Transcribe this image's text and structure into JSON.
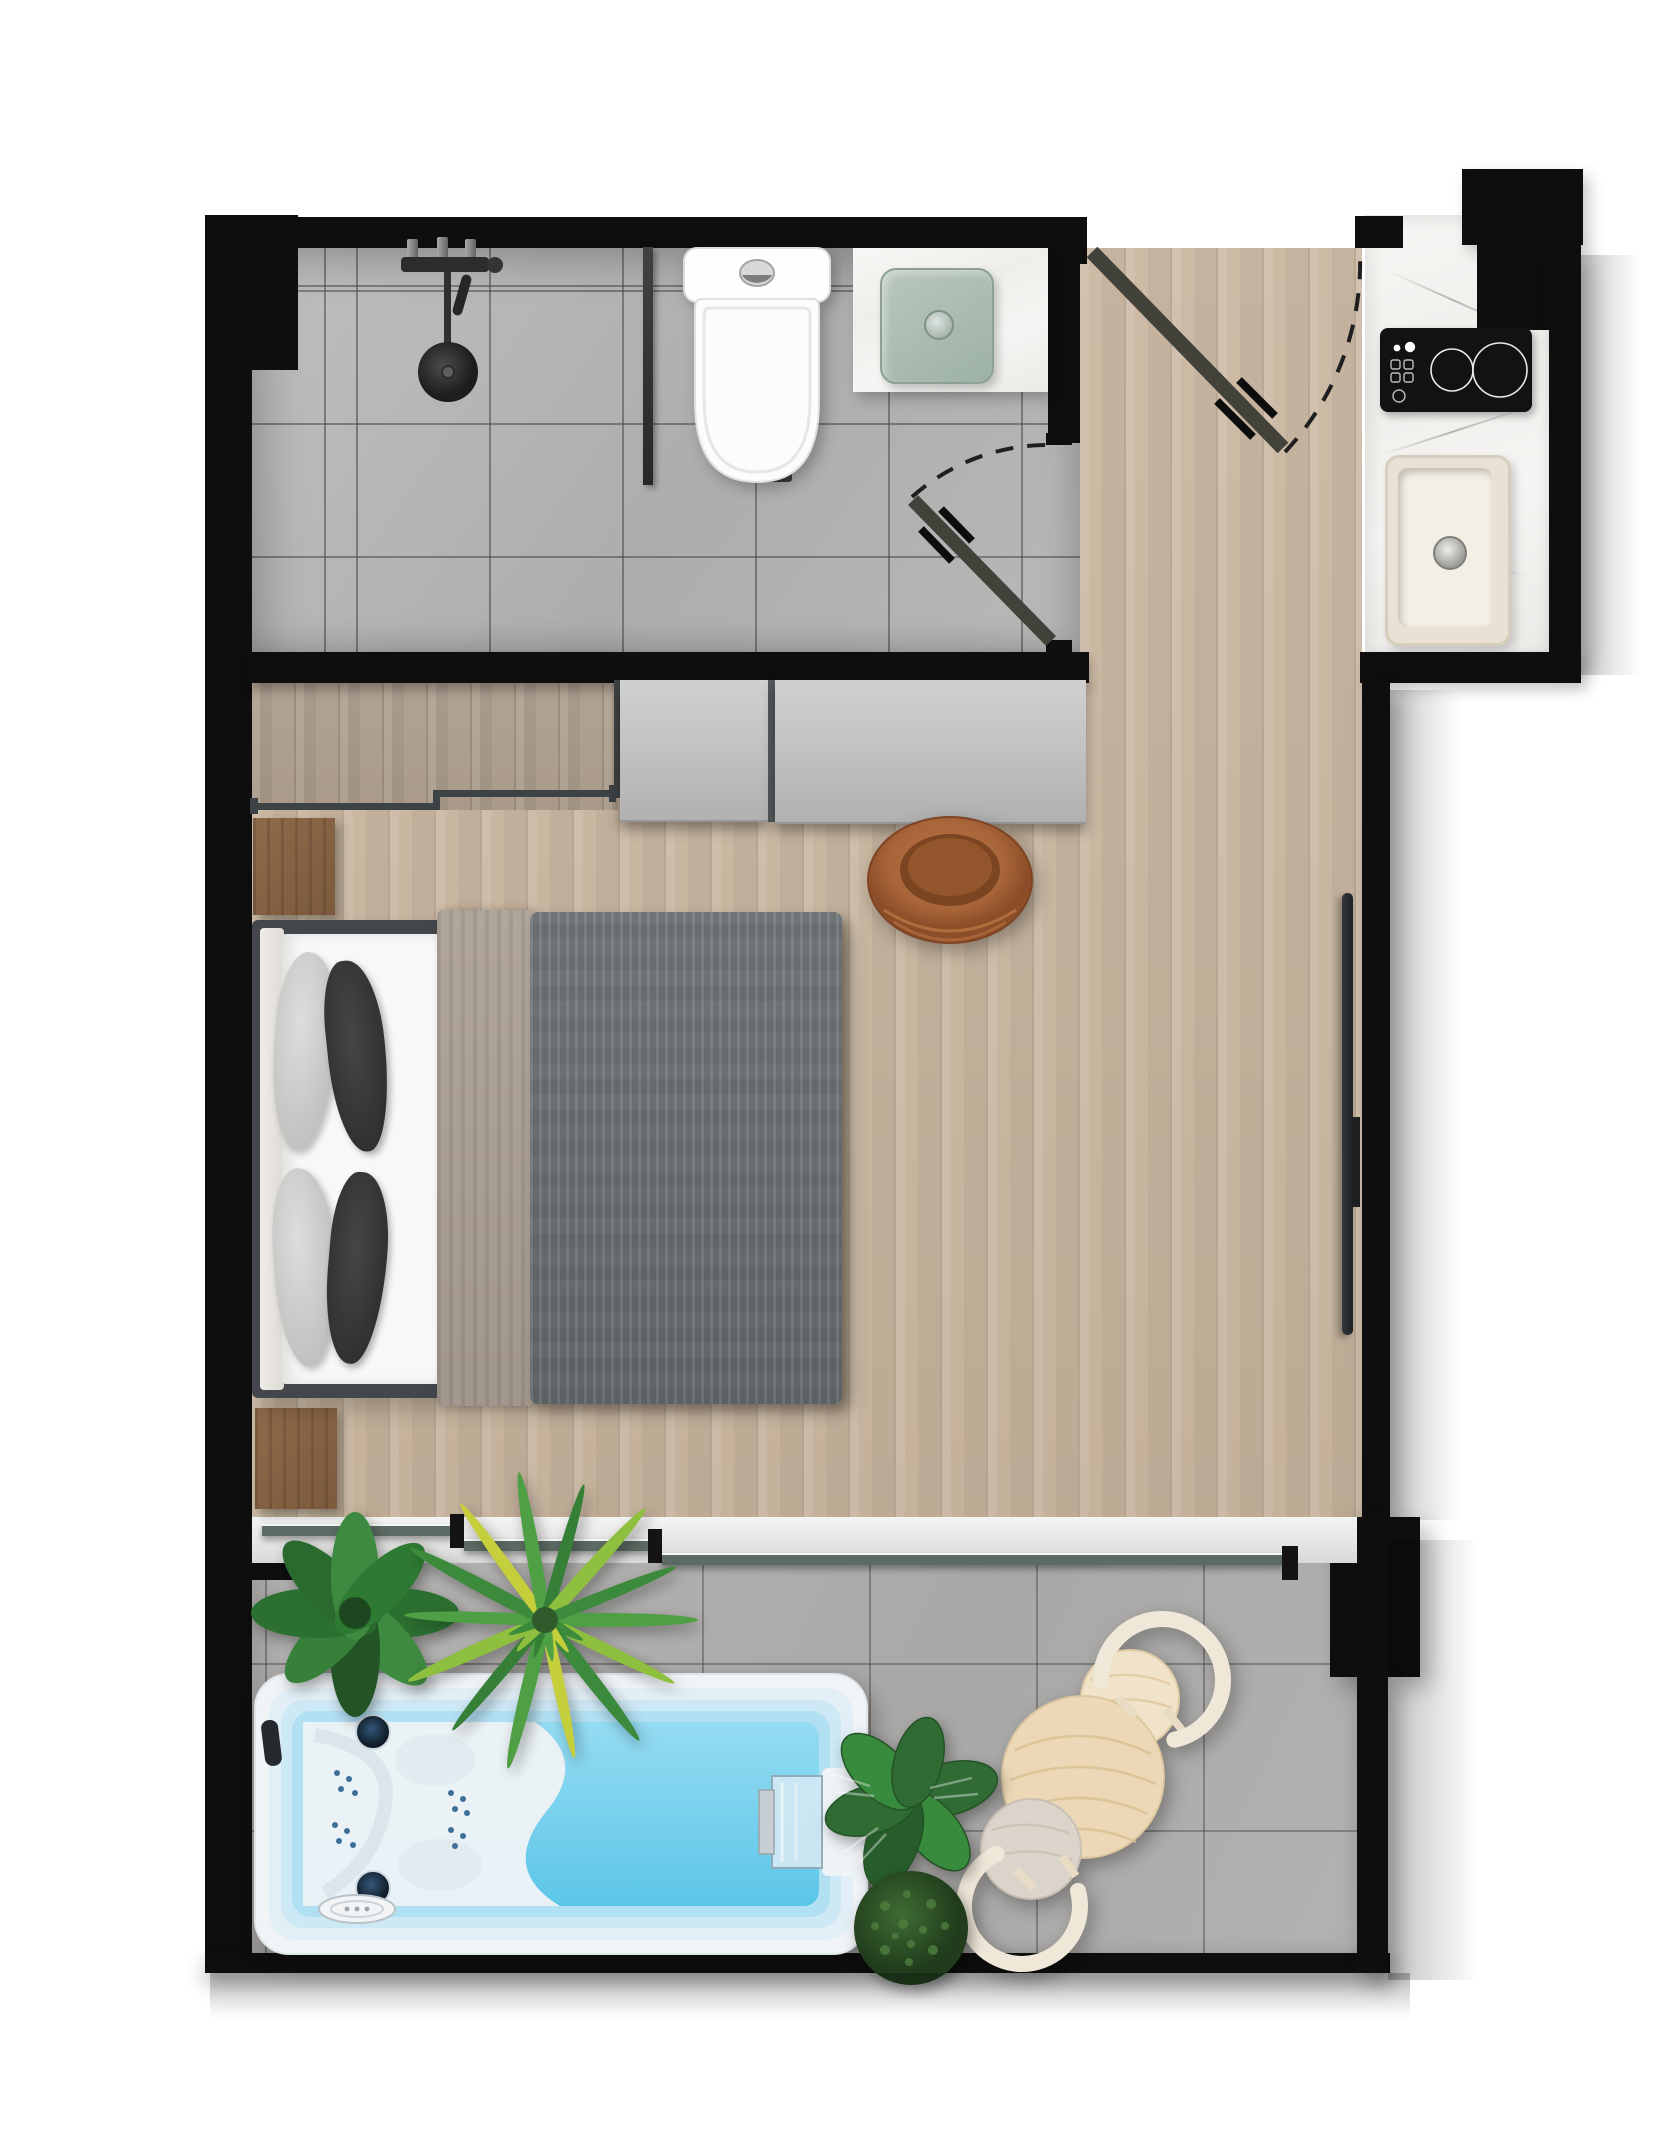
{
  "meta": {
    "title": "Studio Apartment Floor Plan",
    "type": "architectural floor plan",
    "view": "top-down 2D render",
    "canvas": {
      "width_px": 1655,
      "height_px": 2155
    }
  },
  "legend": {
    "walls": "solid black fill",
    "doors": "door leaf with dashed swing arc",
    "glazing": "thin dark line on white sill"
  },
  "rooms": [
    {
      "id": "bathroom",
      "label": "Bathroom",
      "floor": "grey ceramic tile",
      "fixtures": [
        {
          "name": "rain shower with black fixtures"
        },
        {
          "name": "glass shower screen"
        },
        {
          "name": "linear floor drain"
        },
        {
          "name": "toilet"
        },
        {
          "name": "stone vanity counter"
        },
        {
          "name": "vessel basin",
          "basin_color": "sage green"
        },
        {
          "name": "hinged door with swing arc"
        }
      ]
    },
    {
      "id": "entry",
      "label": "Entry hall",
      "floor": "oak plank",
      "fixtures": [
        {
          "name": "entrance door with swing arc"
        }
      ]
    },
    {
      "id": "kitchen",
      "label": "Kitchenette",
      "fixtures": [
        {
          "name": "stone worktop"
        },
        {
          "name": "induction cooktop",
          "zones": 2
        },
        {
          "name": "single-bowl sink"
        }
      ]
    },
    {
      "id": "wardrobe",
      "label": "Wardrobe / walk-in closet",
      "fixtures": [
        {
          "name": "sliding wardrobe panel",
          "count": 2
        },
        {
          "name": "open rail threshold"
        }
      ]
    },
    {
      "id": "living",
      "label": "Living and sleeping area",
      "floor": "oak plank",
      "furniture": [
        {
          "name": "double bed",
          "pillows": 4,
          "bedding": [
            "white sheet",
            "taupe throw",
            "grey duvet"
          ]
        },
        {
          "name": "nightstand",
          "count": 2
        },
        {
          "name": "leather lounge chair"
        },
        {
          "name": "wall-mounted TV"
        }
      ]
    },
    {
      "id": "balcony",
      "label": "Balcony terrace",
      "floor": "concrete tile",
      "access": {
        "name": "sliding glass door",
        "panels": 3
      },
      "furniture": [
        {
          "name": "swim spa",
          "features": [
            "hydro jet seats",
            "headrest",
            "waterfall feature",
            "control panel"
          ]
        },
        {
          "name": "round side table"
        },
        {
          "name": "curved lounge chair",
          "count": 2
        },
        {
          "name": "potted plant",
          "count": 4
        }
      ]
    }
  ],
  "palette": {
    "wall": "#0e0e0e",
    "oak_floor": "#c9b7a2",
    "closet_floor": "#b0a292",
    "bath_tile": "#b7b7b7",
    "balcony_tile": "#b2b1af",
    "counter": "#f5f4f2",
    "basin_sage": "#aabfb2",
    "spa_water": "#6fcfec",
    "spa_shell": "#eef3f6",
    "duvet_grey": "#70767a",
    "throw_taupe": "#aca195",
    "leather": "#a9653a",
    "pale_wood": "#ecd8b7",
    "panel_grey": "#c2c2c2",
    "plant_green": "#2f7a33",
    "glass_line": "#5c6b63"
  }
}
